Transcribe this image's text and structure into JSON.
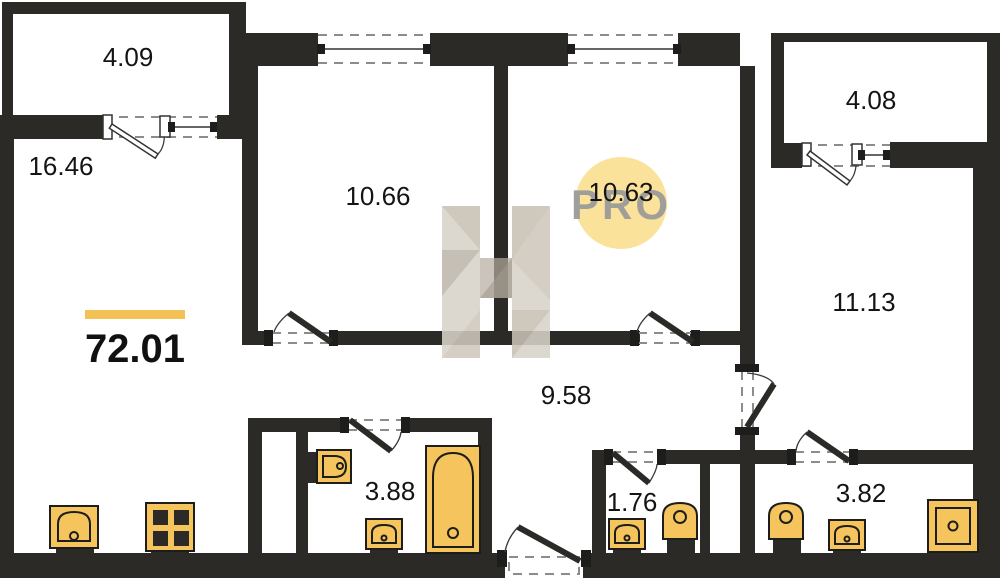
{
  "floorplan": {
    "total_area": "72.01",
    "watermark_badge": "PRO",
    "rooms": [
      {
        "name": "balcony-top-left",
        "area": "4.09"
      },
      {
        "name": "living-kitchen",
        "area": "16.46"
      },
      {
        "name": "bedroom-1",
        "area": "10.66"
      },
      {
        "name": "bedroom-2",
        "area": "10.63"
      },
      {
        "name": "bedroom-3",
        "area": "11.13"
      },
      {
        "name": "balcony-top-right",
        "area": "4.08"
      },
      {
        "name": "hallway",
        "area": "9.58"
      },
      {
        "name": "bathroom",
        "area": "3.88"
      },
      {
        "name": "wc",
        "area": "1.76"
      },
      {
        "name": "shower-room",
        "area": "3.82"
      }
    ],
    "colors": {
      "wall": "#2b2a27",
      "fixture_fill": "#f5c45c",
      "accent_bar": "#f3c156",
      "watermark_circle": "#fbe29b",
      "watermark_text": "#9b9b99"
    },
    "icons": [
      "window-icon",
      "door-icon",
      "kitchen-sink-icon",
      "stove-icon",
      "toilet-icon",
      "washbasin-icon",
      "bathtub-icon",
      "shower-icon",
      "pro-badge",
      "brand-watermark"
    ]
  }
}
